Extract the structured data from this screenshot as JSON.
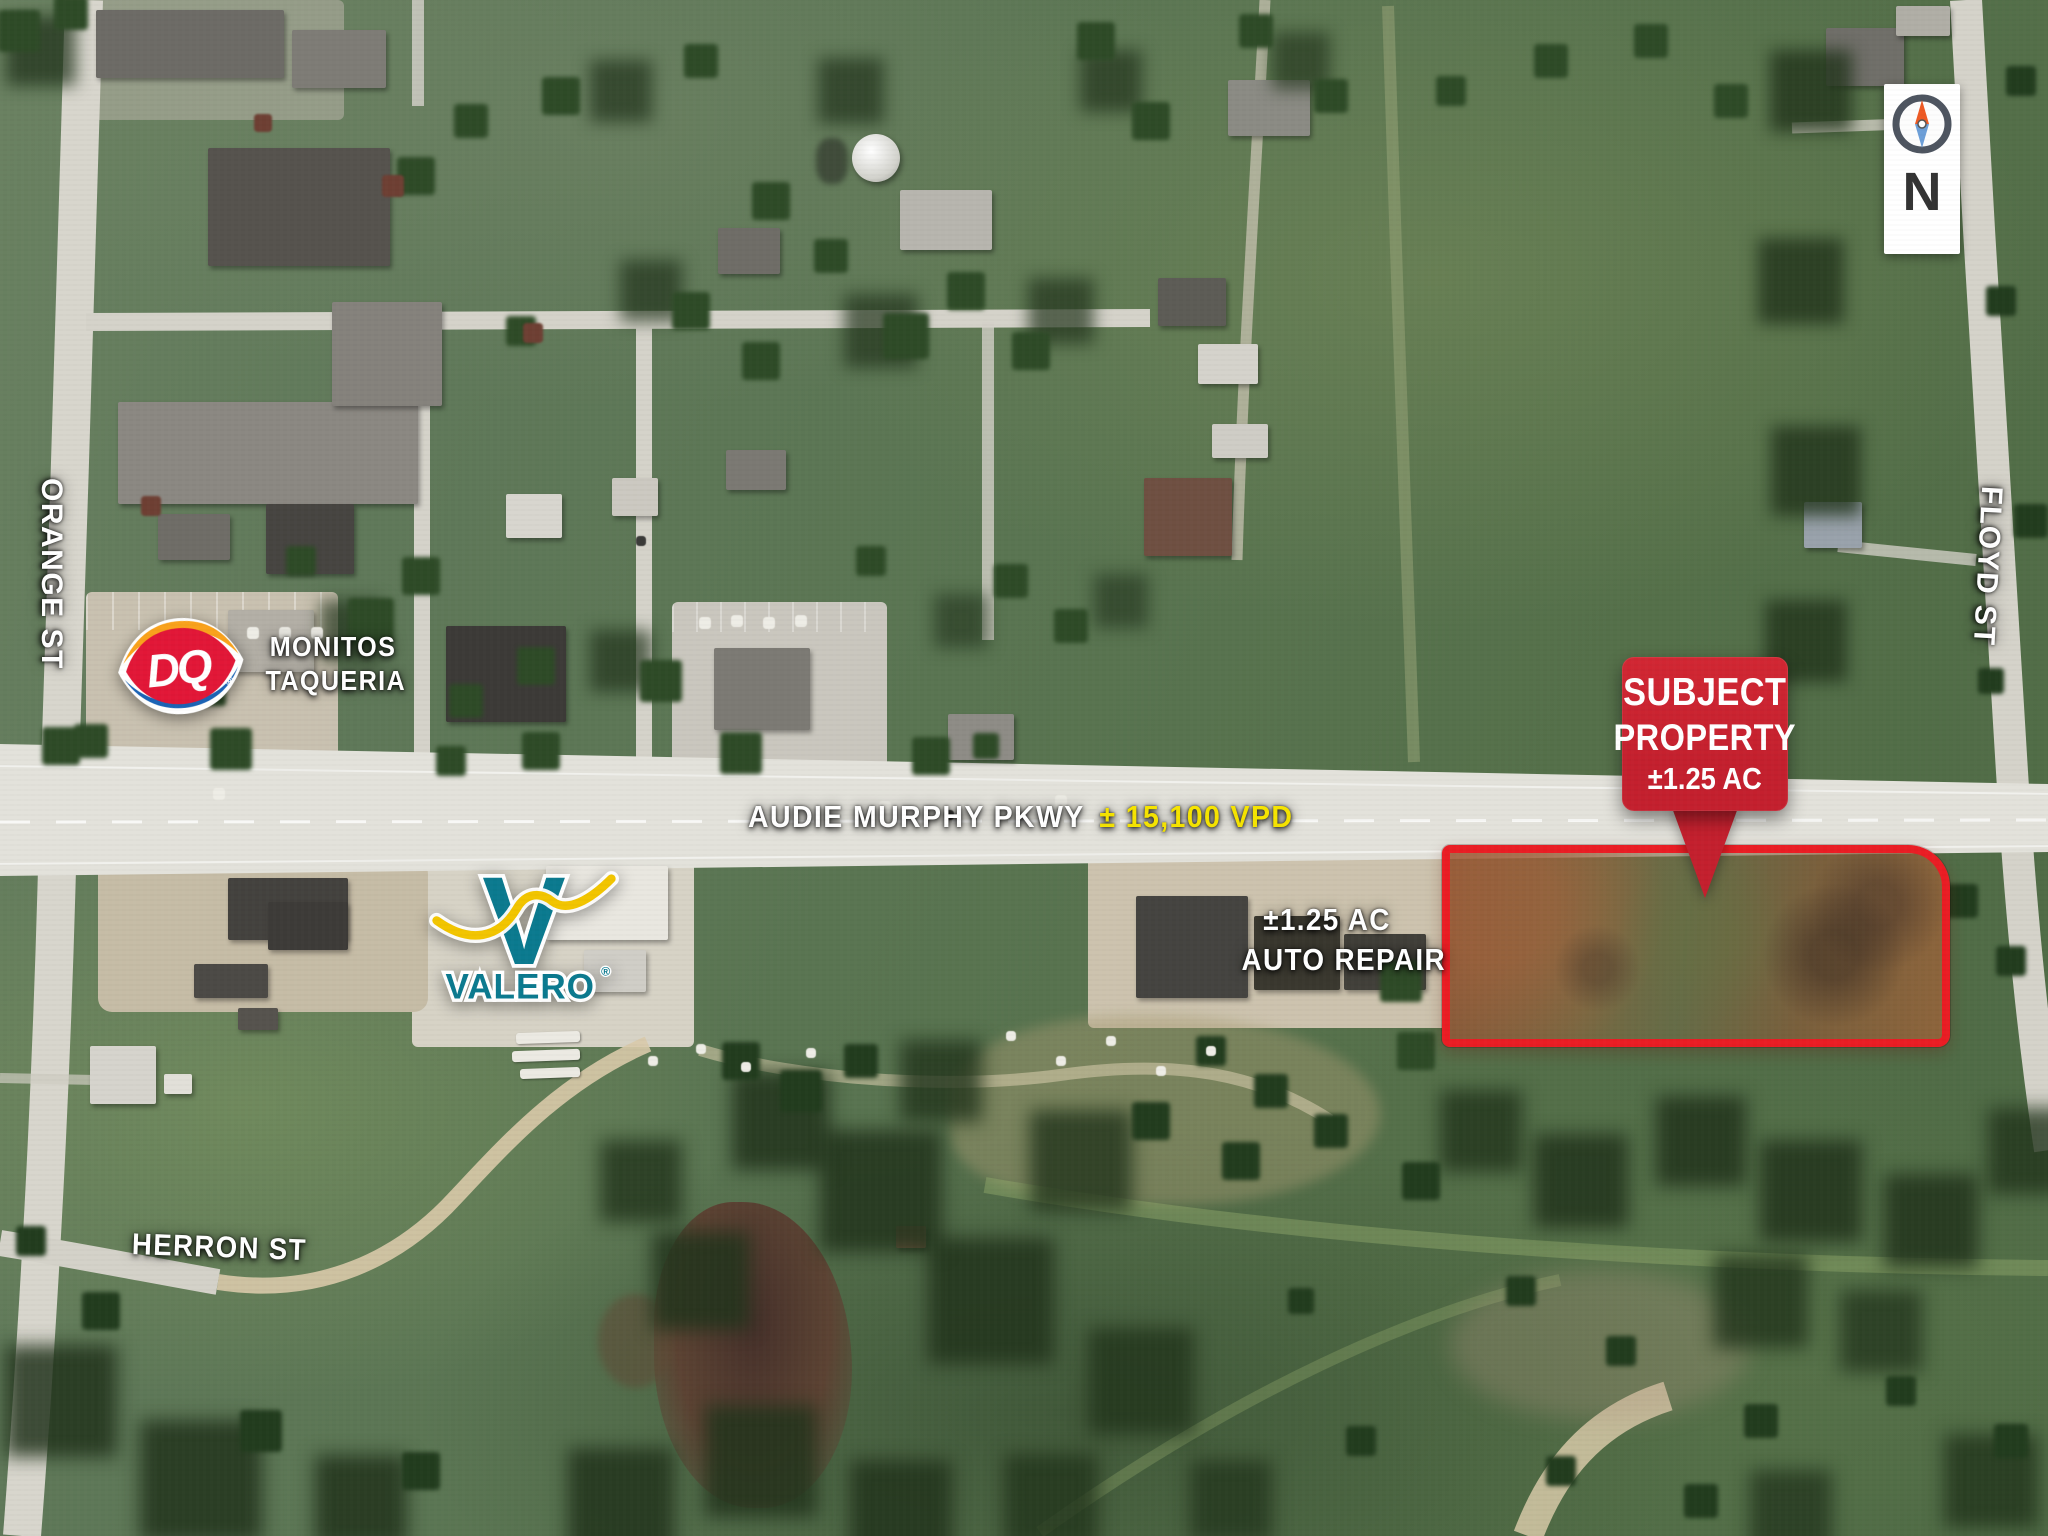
{
  "map_labels": {
    "orange_st": "ORANGE ST",
    "floyd_st": "FLOYD ST",
    "herron_st": "HERRON ST",
    "parkway_name": "AUDIE MURPHY PKWY",
    "parkway_traffic": "± 15,100 VPD",
    "monitos_line1": "MONITOS",
    "monitos_line2": "TAQUERIA",
    "auto_repair_acreage": "±1.25 AC",
    "auto_repair_name": "AUTO REPAIR"
  },
  "subject_callout": {
    "line1": "SUBJECT",
    "line2": "PROPERTY",
    "line3": "±1.25 AC"
  },
  "compass": {
    "north_label": "N"
  },
  "logos": {
    "dq": {
      "monogram": "DQ",
      "registered": "®"
    },
    "valero": {
      "initial": "V",
      "wordmark": "VALERO",
      "registered": "®"
    }
  },
  "colors": {
    "subject_outline": "#ea1d24",
    "callout_red": "#c4202e",
    "traffic_yellow": "#f6e400",
    "valero_teal": "#0b7a8f",
    "valero_yellow": "#f2c500",
    "dq_red": "#e21737",
    "dq_orange": "#f9a21c",
    "dq_blue": "#1b63b5"
  }
}
